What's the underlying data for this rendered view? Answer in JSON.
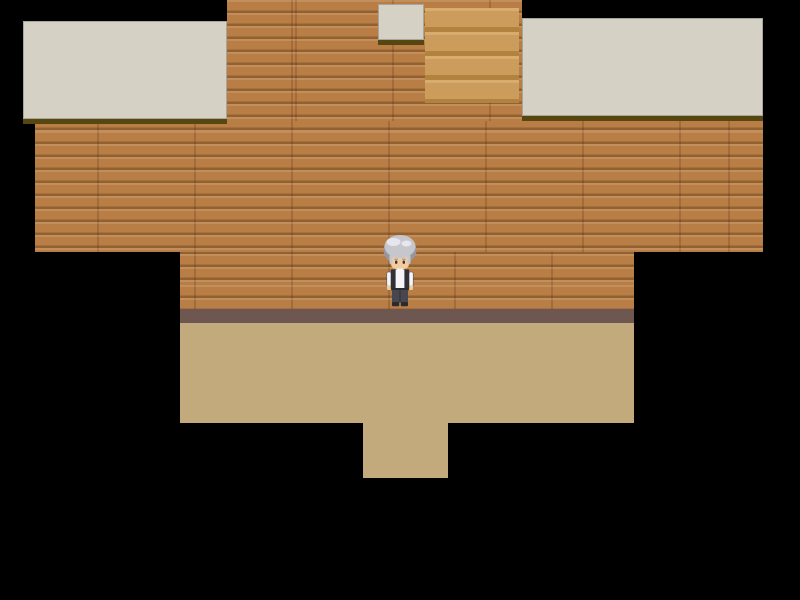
{
  "scene": {
    "name": "rpg-map-house-exterior",
    "viewport": {
      "width": 800,
      "height": 600,
      "background_color": "#000000"
    },
    "palette": {
      "brick_base": "#b97e45",
      "brick_highlight": "rgba(255,255,255,0.12)",
      "brick_shadow": "rgba(58,30,6,0.30)",
      "brick_seam": "rgba(58,30,6,0.18)",
      "roof": "#d5d2c5",
      "roof_edge": "#a8a69c",
      "roof_shadow": "#564711",
      "steps_light": "#d8ac6e",
      "steps_mid": "#cb9c5c",
      "steps_dark": "#b2823f",
      "baseboard": "#6f5751",
      "floor": "#c2aa7d"
    },
    "regions": [
      {
        "name": "wall-upper",
        "kind": "brick",
        "x": 227,
        "y": 0,
        "w": 295,
        "h": 124
      },
      {
        "name": "wall-middle",
        "kind": "brick",
        "x": 35,
        "y": 121,
        "w": 728,
        "h": 131
      },
      {
        "name": "wall-lower",
        "kind": "brick",
        "x": 180,
        "y": 252,
        "w": 454,
        "h": 57
      },
      {
        "name": "baseboard",
        "kind": "baseboard",
        "x": 180,
        "y": 309,
        "w": 454,
        "h": 14
      },
      {
        "name": "floor-main",
        "kind": "floor",
        "x": 180,
        "y": 323,
        "w": 454,
        "h": 100
      },
      {
        "name": "floor-extension",
        "kind": "floor",
        "x": 363,
        "y": 423,
        "w": 85,
        "h": 55
      },
      {
        "name": "roof-left",
        "kind": "roof",
        "x": 23,
        "y": 21,
        "w": 204,
        "h": 98
      },
      {
        "name": "roof-right",
        "kind": "roof",
        "x": 522,
        "y": 18,
        "w": 241,
        "h": 98
      },
      {
        "name": "roof-dormer",
        "kind": "roof",
        "x": 378,
        "y": 4,
        "w": 46,
        "h": 36
      },
      {
        "name": "steps",
        "kind": "steps",
        "x": 425,
        "y": 8,
        "w": 94,
        "h": 95
      }
    ],
    "character": {
      "name": "gray-haired-villager",
      "x": 380,
      "y": 233,
      "w": 40,
      "h": 74,
      "facing": "down",
      "colors": {
        "hair": "#c6c6cd",
        "hair_dark": "#96969f",
        "hair_light": "#e6e6ec",
        "skin": "#f2cb9e",
        "eyes": "#403636",
        "shirt": "#f5f5f7",
        "vest": "#303036",
        "outline": "#55555a",
        "belt": "#2c2c30",
        "pants": "#474750",
        "pants_seam": "#32323a",
        "shoes": "#2b2b2f"
      }
    }
  }
}
